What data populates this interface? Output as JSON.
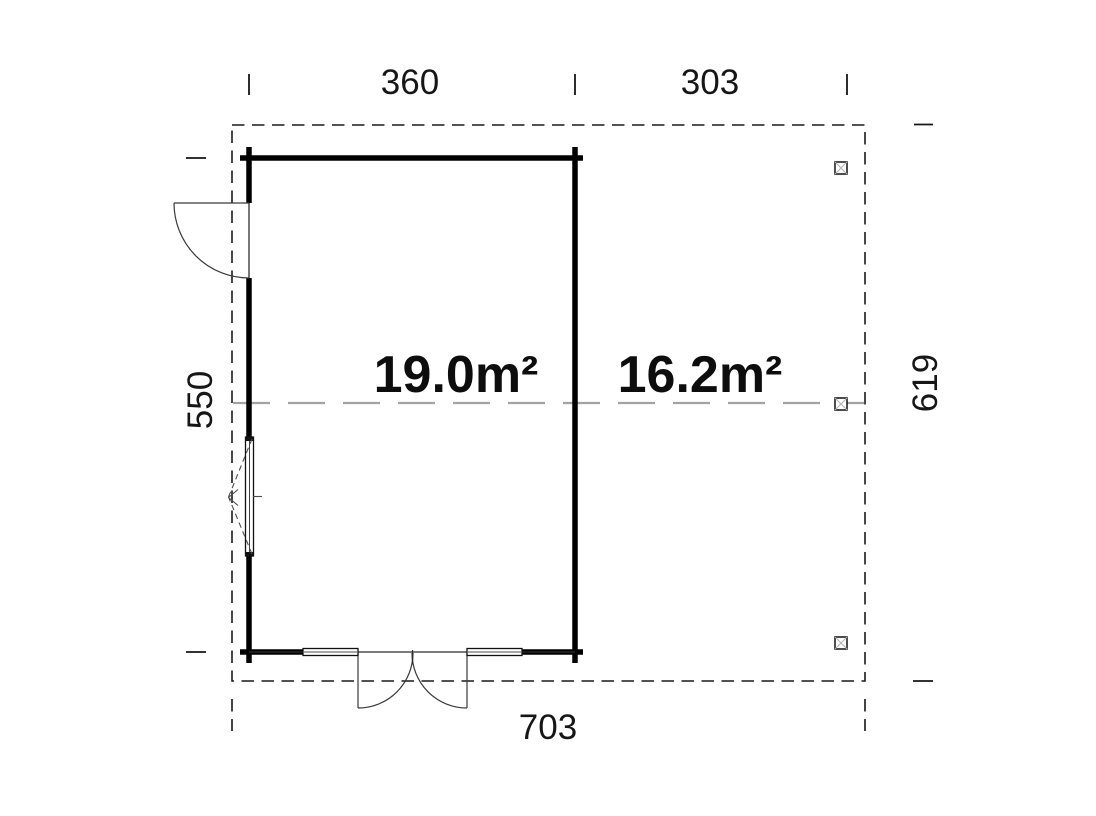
{
  "plan": {
    "dimensions": {
      "top_left": "360",
      "top_right": "303",
      "left": "550",
      "right": "619",
      "bottom": "703"
    },
    "areas": {
      "main_room": "19.0m²",
      "canopy": "16.2m²"
    },
    "colors": {
      "ink": "#161616",
      "wall": "#000000",
      "roof_outline": "#1a1a1a",
      "center_line": "#a3a3a3",
      "post_cross": "#b5b5b5",
      "background": "#ffffff"
    }
  }
}
